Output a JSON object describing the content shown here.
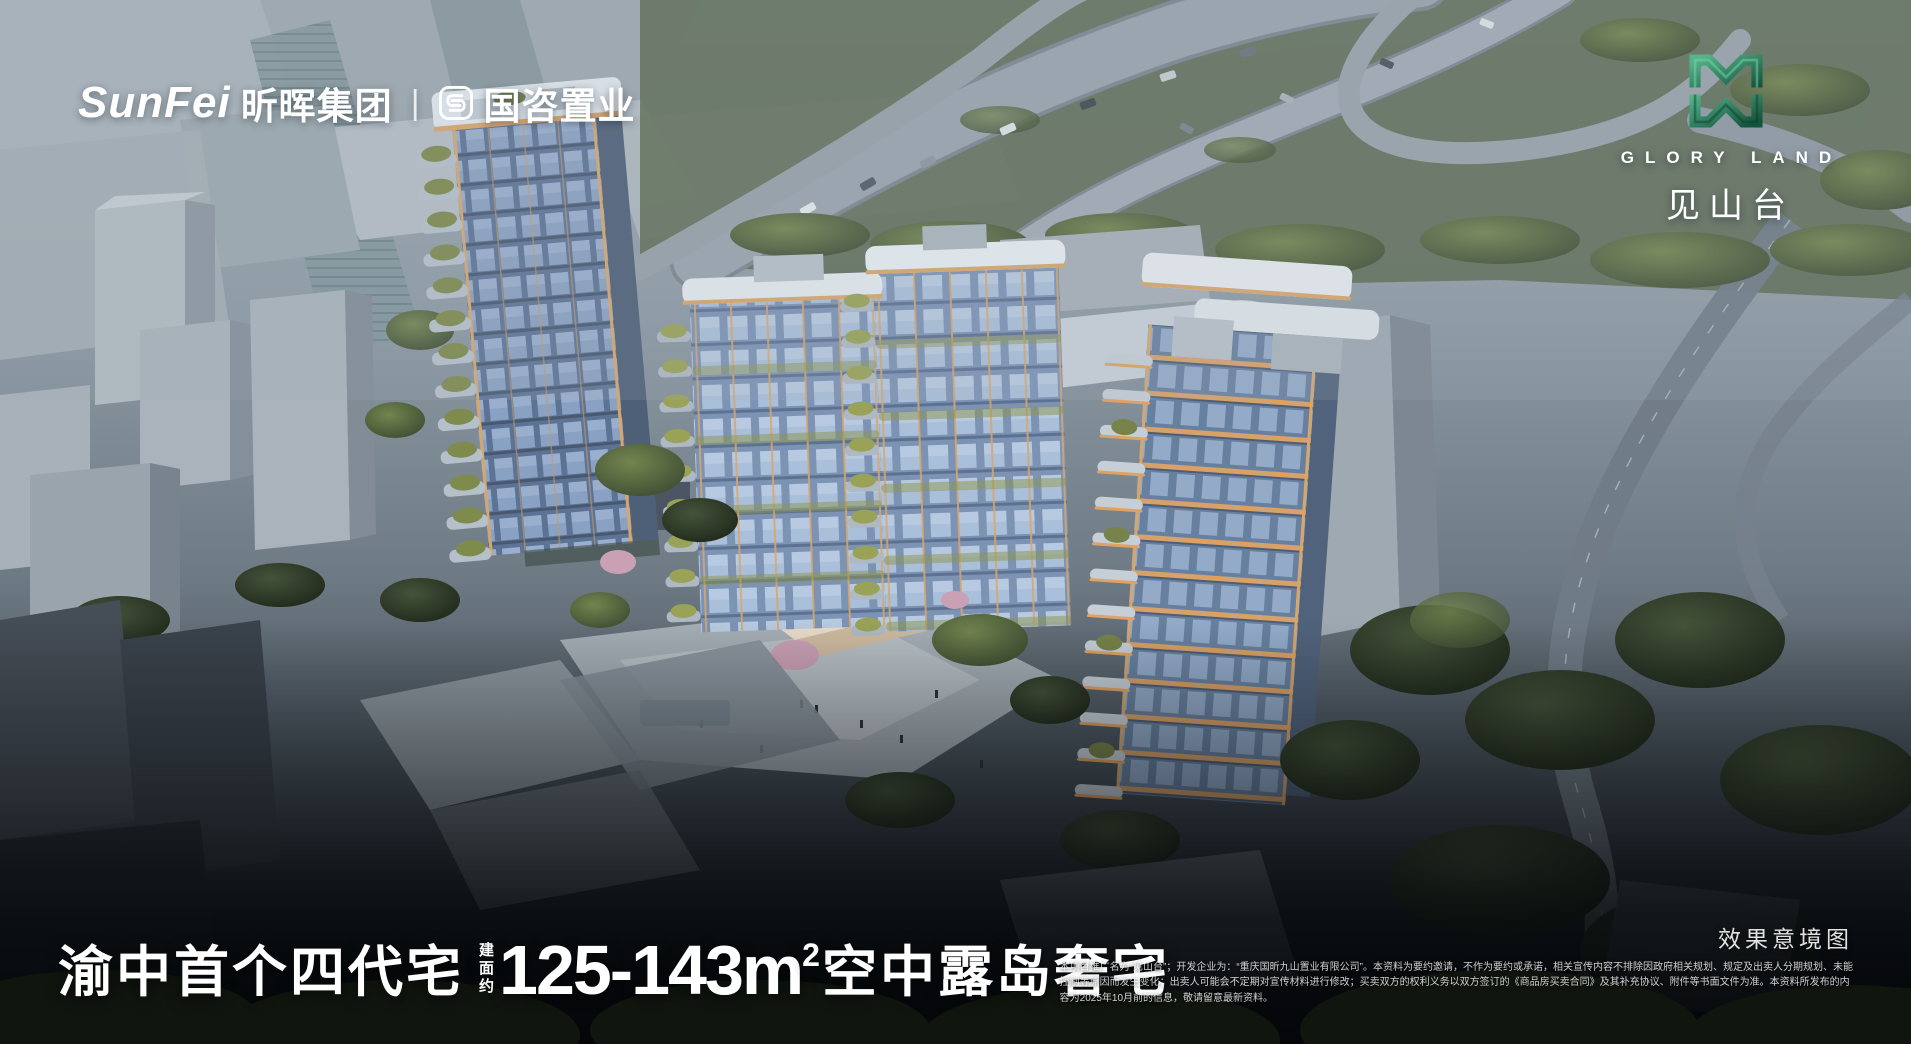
{
  "brand": {
    "latin": "SunFei",
    "group_cn": "昕晖集团",
    "divider": "|",
    "partner_icon": "guozi-seal-icon",
    "partner_cn": "国咨置业"
  },
  "project": {
    "emblem_icon": "gloryland-mw-emblem-icon",
    "name_en": "GLORY LAND",
    "name_cn": "见山台"
  },
  "headline": {
    "prefix": "渝中首个四代宅",
    "area_label": "建面约",
    "area_value": "125-143m",
    "area_sup": "2",
    "suffix": "空中露岛奢宅"
  },
  "caption": {
    "render_label": "效果意境图"
  },
  "disclaimer": {
    "line1": "本项目推广名为“见山台”；开发企业为：“重庆国昕九山置业有限公司”。本资料为要约邀请，不作为要约或承诺，相关宣传内容不排除因政府相关规划、规定及出卖人分期规划、未能",
    "line2": "控制等原因而发生变化；出卖人可能会不定期对宣传材料进行修改；买卖双方的权利义务以双方签订的《商品房买卖合同》及其补充协议、附件等书面文件为准。本资料所发布的内",
    "line3": "容为2025年10月前的信息，敬请留意最新资料。"
  },
  "colors": {
    "logo_green": "#2f8a66",
    "accent_orange": "#dca56a",
    "glass_blue": "#8ba3c4",
    "haze_gray": "#9aa5ae",
    "headline_white": "#ffffff"
  }
}
